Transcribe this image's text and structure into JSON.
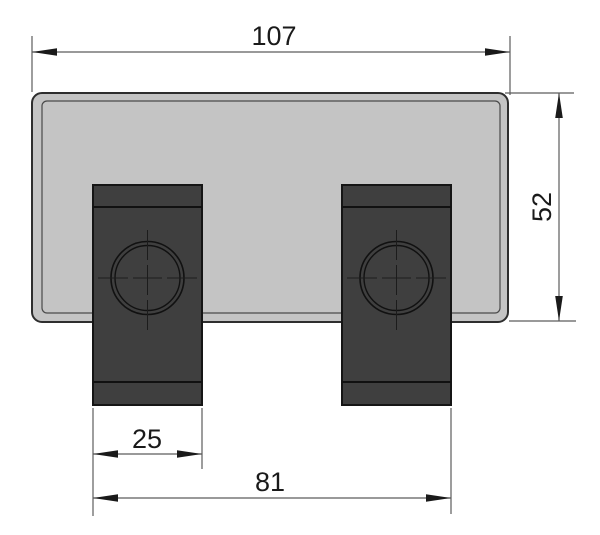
{
  "drawing": {
    "kind": "cad-dimension-drawing",
    "subject": "mounting plate with two clamp blocks, front view",
    "dimensions": {
      "overall_width": {
        "label": "107",
        "orientation": "horizontal",
        "position": "top"
      },
      "overall_height": {
        "label": "52",
        "orientation": "vertical",
        "position": "right"
      },
      "block_width": {
        "label": "25",
        "orientation": "horizontal",
        "position": "bottom-left"
      },
      "block_span": {
        "label": "81",
        "orientation": "horizontal",
        "position": "bottom"
      }
    },
    "colors": {
      "background": "#ffffff",
      "plate_fill": "#c4c4c4",
      "plate_outline": "#2e2e2e",
      "block_fill": "#3f3f3f",
      "block_outline": "#151515",
      "dim_line": "#5c5c5c",
      "text": "#1a1a1a"
    }
  }
}
